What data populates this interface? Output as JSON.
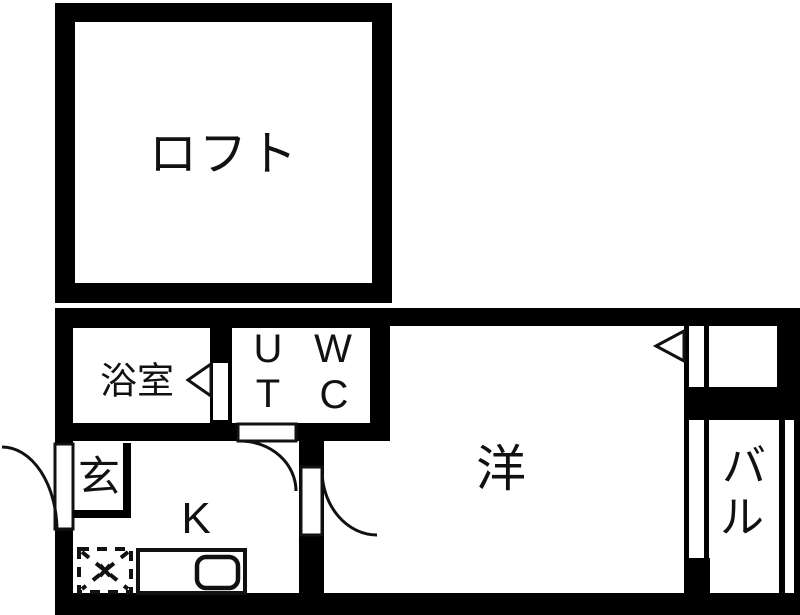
{
  "floorplan": {
    "type": "apartment-floor-plan",
    "colors": {
      "wall": "#000000",
      "floor": "#ffffff",
      "line": "#111111"
    },
    "rooms": {
      "loft": {
        "label": "ロフト"
      },
      "bathroom": {
        "label": "浴室"
      },
      "utility": {
        "top": "U",
        "bottom": "T"
      },
      "toilet": {
        "top": "W",
        "bottom": "C"
      },
      "entrance": {
        "label": "玄"
      },
      "kitchen": {
        "label": "K"
      },
      "western_room": {
        "label": "洋"
      },
      "balcony": {
        "char1": "バ",
        "char2": "ル"
      }
    }
  }
}
